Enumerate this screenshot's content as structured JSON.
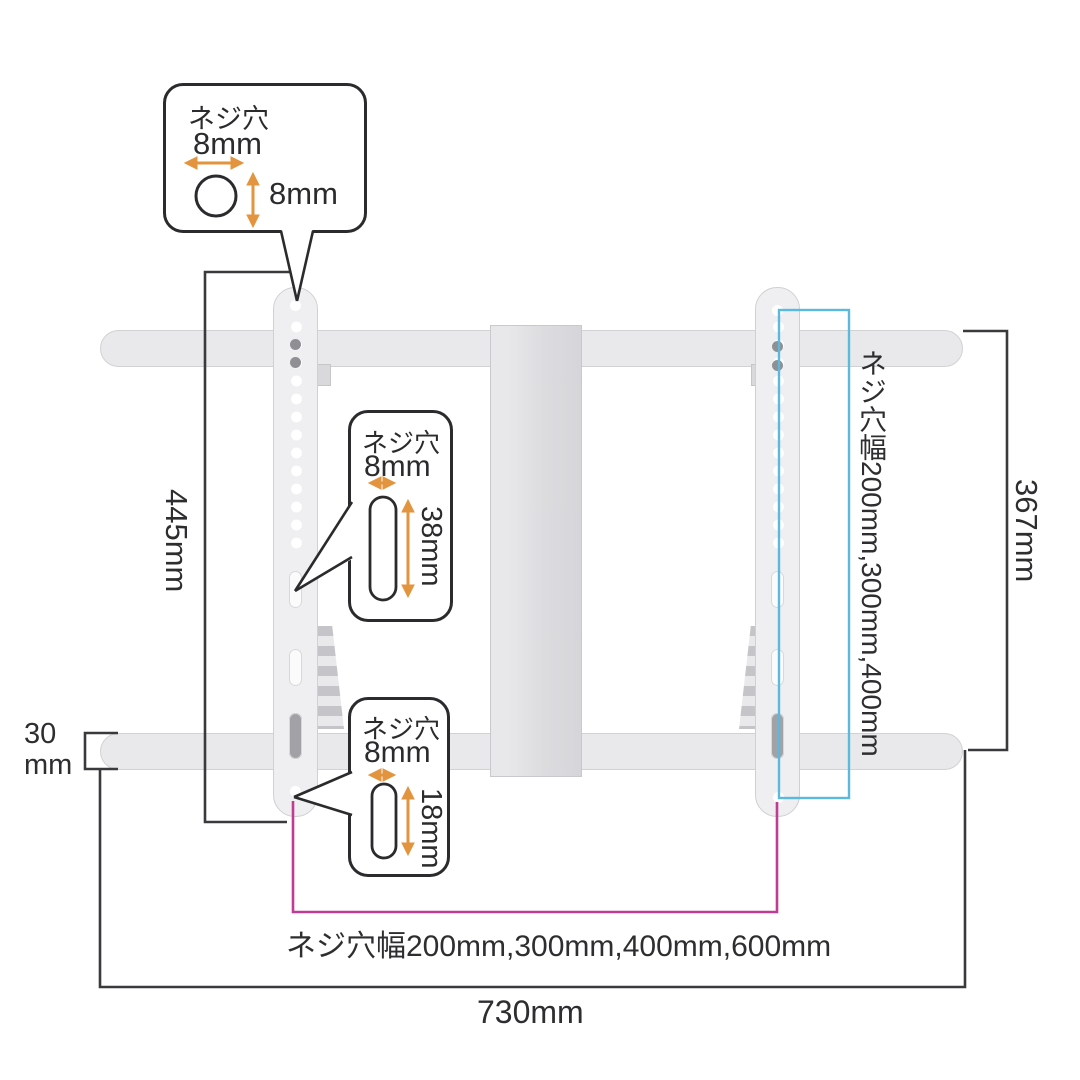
{
  "callouts": {
    "top": {
      "title": "ネジ穴",
      "h_label": "8mm",
      "v_label": "8mm"
    },
    "middle": {
      "title": "ネジ穴",
      "h_label": "8mm",
      "v_label": "38mm"
    },
    "bottom": {
      "title": "ネジ穴",
      "h_label": "8mm",
      "v_label": "18mm"
    }
  },
  "dimensions": {
    "left_height": "445mm",
    "rail_thickness": "30\nmm",
    "total_width": "730mm",
    "right_height": "367mm",
    "vesa_vertical": "ネジ穴幅200mm,300mm,400mm",
    "vesa_horizontal": "ネジ穴幅200mm,300mm,400mm,600mm"
  },
  "colors": {
    "dimension_line": "#3a3a3d",
    "accent_orange": "#e2953e",
    "accent_magenta": "#c03b92",
    "accent_cyan": "#5ab9dd",
    "metal": "#efeff1"
  }
}
